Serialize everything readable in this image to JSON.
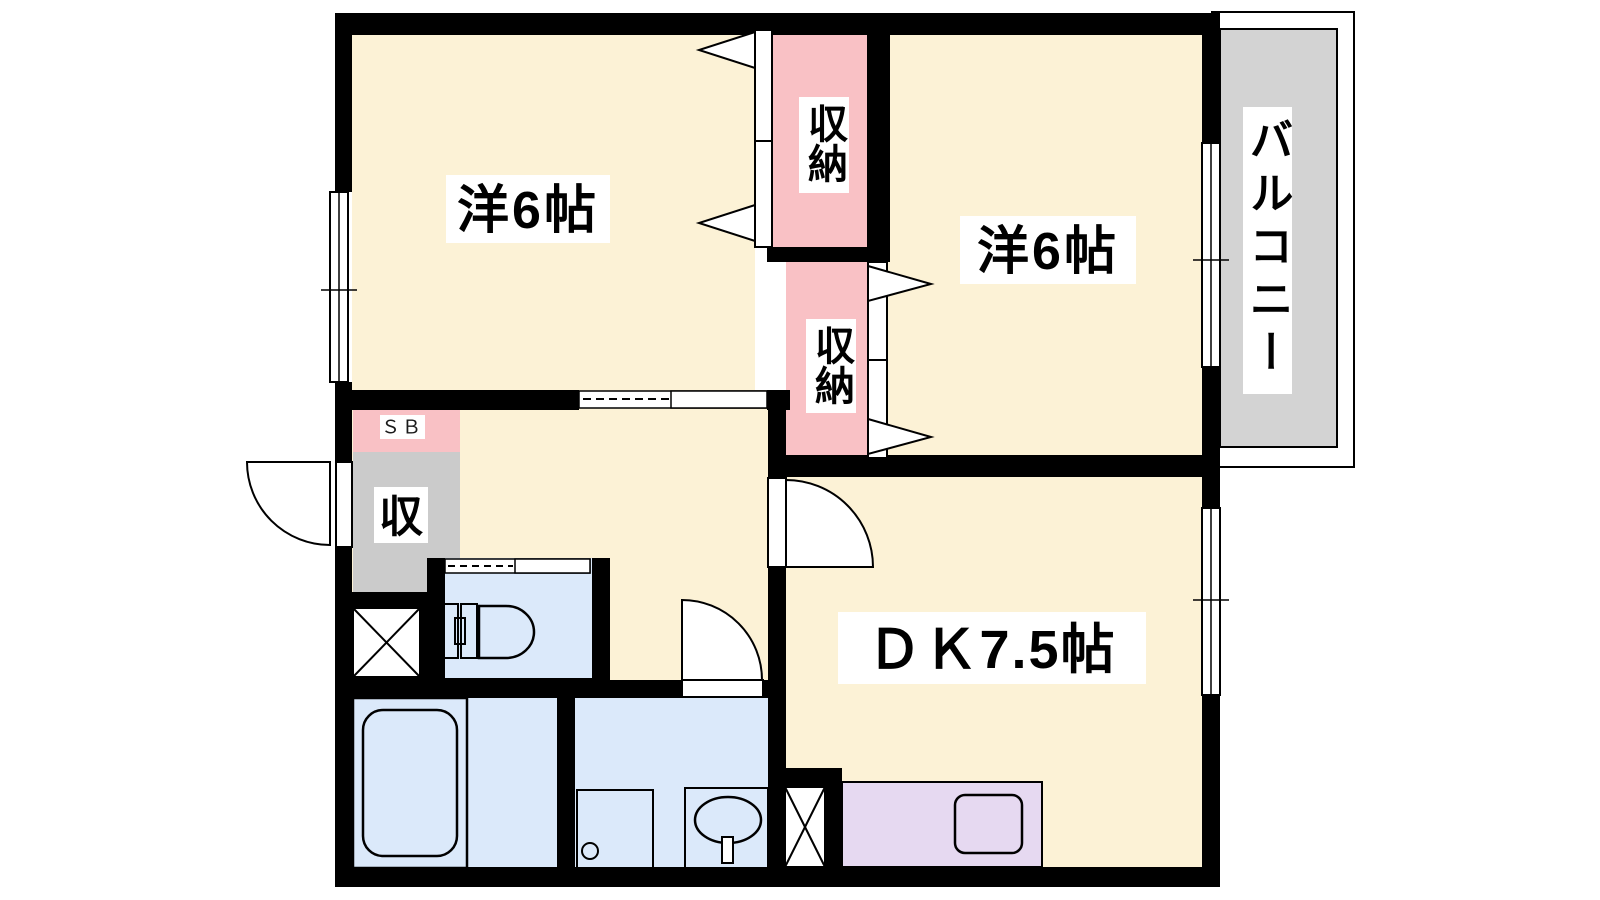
{
  "floor_plan": {
    "type": "apartment-floor-plan",
    "rooms": {
      "western_room_top_left": {
        "label": "洋6帖"
      },
      "western_room_top_right": {
        "label": "洋6帖"
      },
      "dining_kitchen": {
        "label": "ＤＫ7.5帖"
      },
      "closet_upper": {
        "label": "収納"
      },
      "closet_middle": {
        "label": "収納"
      },
      "hall_storage": {
        "label": "収"
      },
      "shoe_box": {
        "label": "ＳＢ"
      },
      "balcony": {
        "label": "バルコニー"
      }
    },
    "colors": {
      "room_floor": "#FCF2D6",
      "closet_pink": "#F9C1C5",
      "storage_gray": "#CBCBCB",
      "wet_area_blue": "#DBE9FA",
      "kitchen_lavender": "#E6D9F1",
      "balcony_gray": "#D3D3D3",
      "wall": "#000000",
      "label_background": "#FFFFFF"
    }
  }
}
